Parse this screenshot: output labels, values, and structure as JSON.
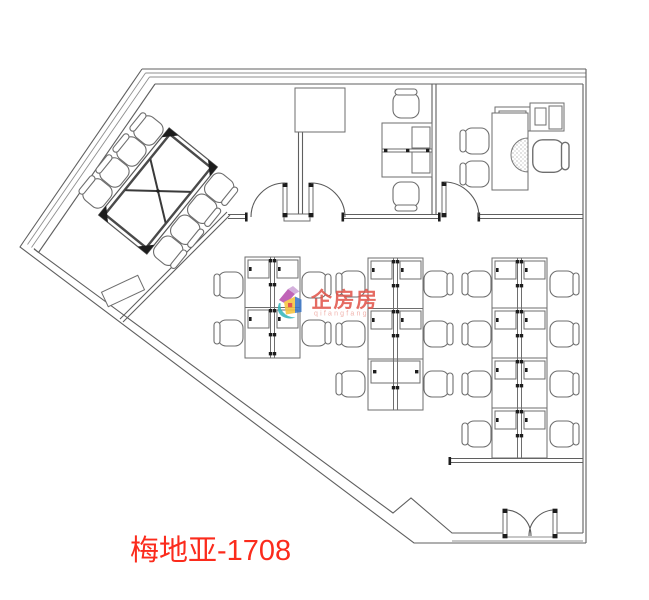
{
  "label": {
    "text": "梅地亚-1708",
    "color": "#fb2b1c"
  },
  "watermark": {
    "brand": "企房房",
    "subbrand": "qifangfang",
    "brand_color": "#e2574d",
    "subbrand_color": "#efa9a2",
    "logo_colors": {
      "roof_left": "#b84fae",
      "roof_right": "#cfa6d8",
      "front": "#f6c33d",
      "side": "#3c77c7",
      "swoosh": "#37b8bd",
      "window": "#e2403a"
    }
  },
  "plan": {
    "background": "#ffffff",
    "wall_line_color": "#5f5f5f",
    "furniture_line_color": "#6e6e6e",
    "accent_black": "#1d1d1d"
  }
}
